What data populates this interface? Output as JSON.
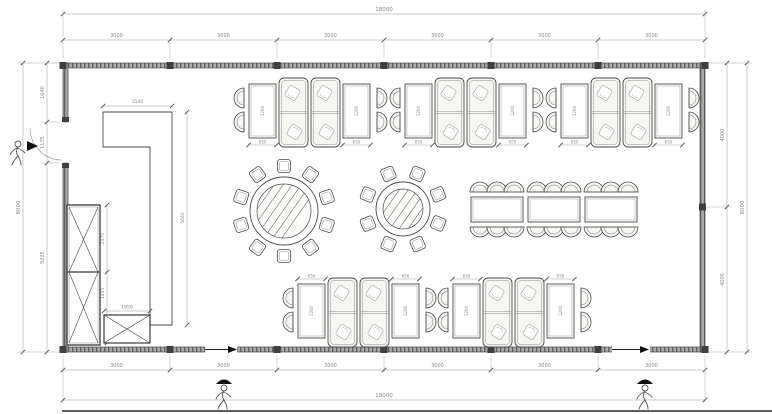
{
  "sheet": {
    "background": "#ffffff",
    "edge_color": "#2a2a2a"
  },
  "palette": {
    "line": "#4a4a4a",
    "light_line": "#8f8f8f",
    "dim_line": "#9b9b9b",
    "dim_text": "#8a8a8a",
    "wall_fill": "#a9a9a9",
    "wall_hatch": "#5f5f5f",
    "wall_dark": "#3f3f3f",
    "furniture_fill": "#f6f6f3",
    "ghost": "#a0a0a0",
    "black": "#111111"
  },
  "plan": {
    "room": {
      "x": 63,
      "y": 63,
      "w": 642,
      "h": 289,
      "wall": 5
    },
    "column_ticks_x": [
      63,
      170,
      277,
      384,
      491,
      598,
      705
    ],
    "right_wall_column_y": 207,
    "door_left": {
      "y1": 122,
      "y2": 163
    },
    "openings_bottom": [
      {
        "x1": 205,
        "x2": 237
      },
      {
        "x1": 612,
        "x2": 650
      }
    ]
  },
  "dimensions": {
    "top": {
      "total": "18000",
      "segments": [
        "3000",
        "3000",
        "3000",
        "3000",
        "3000",
        "3000"
      ]
    },
    "bottom": {
      "total": "18000",
      "segments": [
        "3000",
        "3000",
        "3000",
        "3000",
        "3000",
        "3000"
      ]
    },
    "left": {
      "total": "8000",
      "segments": [
        "1640",
        "1135",
        "5225"
      ]
    },
    "right": {
      "total": "8000",
      "segments": [
        "4000",
        "4000"
      ]
    },
    "partition": {
      "width": "1500",
      "height": "5640"
    },
    "cabinet": {
      "upper": "2470",
      "lower": "1455",
      "low_width": "1950"
    },
    "booth_table": {
      "width": "650",
      "length": "1200"
    }
  },
  "furniture": {
    "booth_units": [
      {
        "x": 235,
        "y": 78,
        "dim_side": "below"
      },
      {
        "x": 391,
        "y": 78,
        "dim_side": "below"
      },
      {
        "x": 547,
        "y": 78,
        "dim_side": "below"
      },
      {
        "x": 284,
        "y": 278,
        "dim_side": "above"
      },
      {
        "x": 439,
        "y": 278,
        "dim_side": "above"
      }
    ],
    "round_tables": [
      {
        "cx": 284,
        "cy": 211,
        "r": 34,
        "seats": 10
      },
      {
        "cx": 403,
        "cy": 209,
        "r": 27,
        "seats": 8
      }
    ],
    "banquet": {
      "x": 471,
      "y": 197,
      "table_w": 52,
      "table_h": 25,
      "gap": 5,
      "tables": 3,
      "chairs_per_side": 3
    },
    "tall_cabinet": {
      "x": 67,
      "y": 205,
      "w": 33,
      "h": 140
    },
    "low_cabinet": {
      "x": 104,
      "y": 315,
      "w": 46,
      "h": 28
    },
    "partition_points": "103,112 172,112 172,325 150,325 150,147 103,147"
  },
  "annotations": {
    "figures": [
      {
        "x": 18,
        "y": 152,
        "name": "person-figure-left",
        "cap": false
      },
      {
        "x": 224,
        "y": 396,
        "name": "person-figure-bottom-left",
        "cap": true
      },
      {
        "x": 645,
        "y": 396,
        "name": "person-figure-bottom-right",
        "cap": true
      }
    ],
    "door_arrow": {
      "points": "27,141 38,146 27,151"
    },
    "opening_arrows": [
      {
        "line": [
          205,
          349.5,
          228,
          349.5
        ],
        "head": "228,346 237,349.5 228,353"
      },
      {
        "line": [
          612,
          349.5,
          640,
          349.5
        ],
        "head": "640,346 649,349.5 640,353"
      }
    ]
  }
}
